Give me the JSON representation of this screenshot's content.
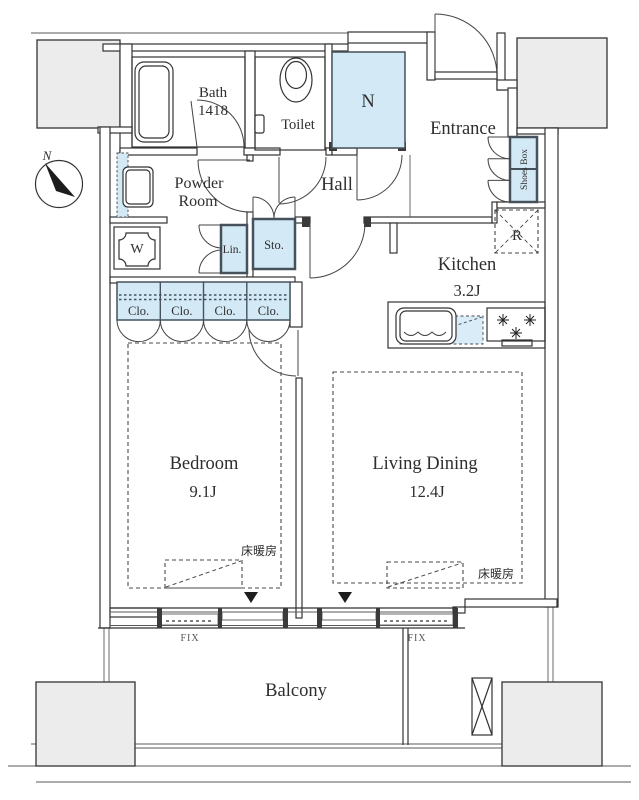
{
  "plan": {
    "compass_label": "N",
    "rooms": {
      "bath": {
        "name": "Bath",
        "size": "1418"
      },
      "toilet": {
        "name": "Toilet"
      },
      "n_storage": {
        "name": "N"
      },
      "entrance": {
        "name": "Entrance"
      },
      "hall": {
        "name": "Hall"
      },
      "powder_room": {
        "line1": "Powder",
        "line2": "Room"
      },
      "kitchen": {
        "name": "Kitchen",
        "size": "3.2J"
      },
      "bedroom": {
        "name": "Bedroom",
        "size": "9.1J"
      },
      "living_dining": {
        "name": "Living Dining",
        "size": "12.4J"
      },
      "balcony": {
        "name": "Balcony"
      }
    },
    "fixtures": {
      "washing_machine": "W",
      "refrigerator": "R",
      "shoes_box": "Shoes Box",
      "storage": "Sto.",
      "linen": "Lin.",
      "closets": [
        "Clo.",
        "Clo.",
        "Clo.",
        "Clo."
      ],
      "floor_heating": "床暖房",
      "fix_window": "FIX"
    },
    "colors": {
      "fixture_fill": "#d3e9f6",
      "outside_fill": "#ececec",
      "line": "#333333",
      "box_border": "#45525c"
    }
  }
}
